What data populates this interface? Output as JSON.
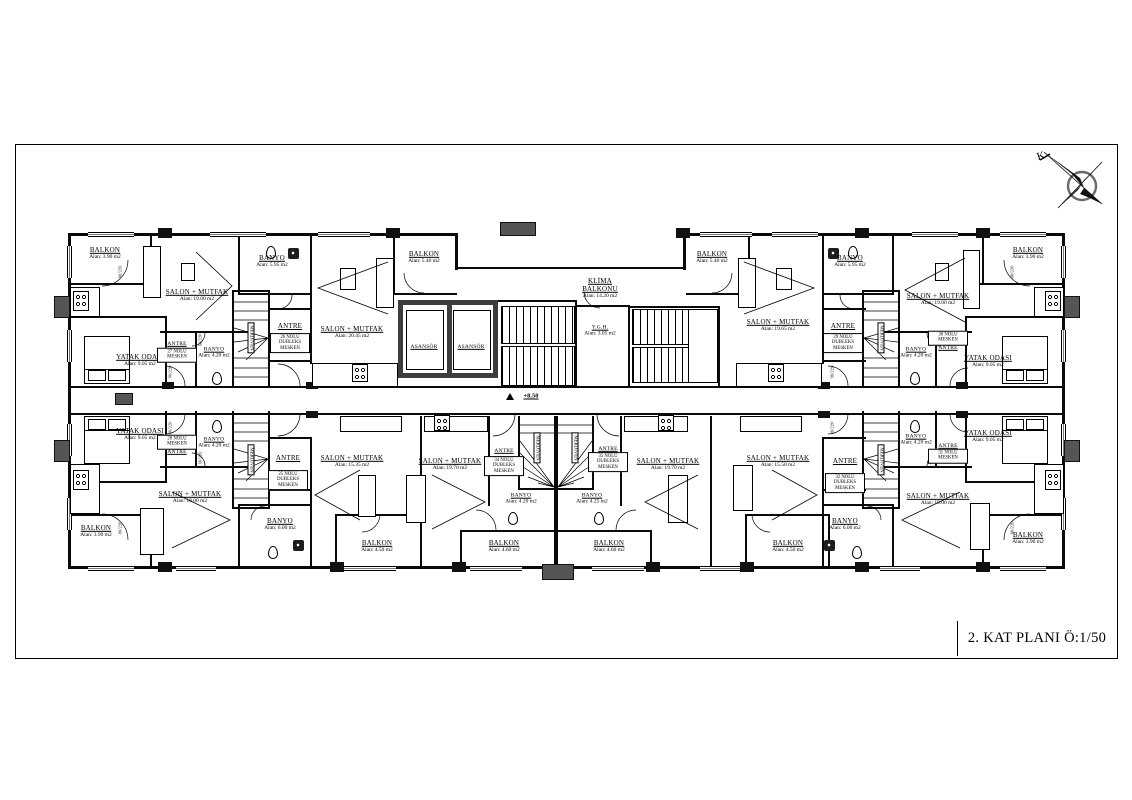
{
  "plan": {
    "title": "2. KAT PLANI Ö:1/50",
    "compass_label": "K",
    "level_mark": "+8.50",
    "stair_label": "MERDİVEN",
    "elevator_label": "ASANSÖR"
  },
  "doors": {
    "size_90": "90/220",
    "size_80": "80/220",
    "size_60": "60/220"
  },
  "units": {
    "u25": "25 NOLU DUBLEKS MESKEN",
    "u26": "26 NOLU DUBLEKS MESKEN",
    "u27": "27 NOLU MESKEN",
    "u28": "28 NOLU MESKEN",
    "u29": "29 NOLU DUBLEKS MESKEN",
    "u30": "30 NOLU MESKEN",
    "u31": "31 NOLU MESKEN",
    "u32": "32 NOLU DUBLEKS MESKEN",
    "u34": "34 NOLU DUBLEKS MESKEN",
    "u35": "35 NOLU DUBLEKS MESKEN"
  },
  "rooms": {
    "t1": {
      "name": "BALKON",
      "area": "Alan: 3.90 m2"
    },
    "t2": {
      "name": "SALON + MUTFAK",
      "area": "Alan: 19.00 m2"
    },
    "t3": {
      "name": "YATAK ODASI",
      "area": "Alan: 9.05 m2"
    },
    "t4": {
      "name": "ANTRE"
    },
    "t5": {
      "name": "BANYO",
      "area": "Alan: 4.20 m2"
    },
    "t6": {
      "name": "BANYO",
      "area": "Alan: 5.95 m2"
    },
    "t7": {
      "name": "ANTRE"
    },
    "t8": {
      "name": "SALON + MUTFAK",
      "area": "Alan: 20.45 m2"
    },
    "t9": {
      "name": "BALKON",
      "area": "Alan: 5.40 m2"
    },
    "t12": {
      "name": "KLİMA BALKONU",
      "area": "Alan: 14.20 m2"
    },
    "t13": {
      "name": "Y.G.H.",
      "area": "Alan: 3.05 m2"
    },
    "t14": {
      "name": "BALKON",
      "area": "Alan: 5.40 m2"
    },
    "t15": {
      "name": "SALON + MUTFAK",
      "area": "Alan: 19.65 m2"
    },
    "t16": {
      "name": "BANYO",
      "area": "Alan: 5.95 m2"
    },
    "t17": {
      "name": "ANTRE"
    },
    "t18": {
      "name": "SALON + MUTFAK",
      "area": "Alan: 19.00 m2"
    },
    "t19": {
      "name": "BANYO",
      "area": "Alan: 4.20 m2"
    },
    "t20": {
      "name": "ANTRE"
    },
    "t21": {
      "name": "YATAK ODASI",
      "area": "Alan: 9.05 m2"
    },
    "t22": {
      "name": "BALKON",
      "area": "Alan: 3.90 m2"
    },
    "b1": {
      "name": "YATAK ODASI",
      "area": "Alan: 9.05 m2"
    },
    "b2": {
      "name": "ANTRE"
    },
    "b3": {
      "name": "BANYO",
      "area": "Alan: 4.20 m2"
    },
    "b4": {
      "name": "SALON + MUTFAK",
      "area": "Alan: 19.00 m2"
    },
    "b5": {
      "name": "BALKON",
      "area": "Alan: 3.90 m2"
    },
    "b6": {
      "name": "BANYO",
      "area": "Alan: 6.00 m2"
    },
    "b7": {
      "name": "ANTRE"
    },
    "b8": {
      "name": "SALON + MUTFAK",
      "area": "Alan: 15.35 m2"
    },
    "b9": {
      "name": "BALKON",
      "area": "Alan: 4.50 m2"
    },
    "b10": {
      "name": "SALON + MUTFAK",
      "area": "Alan: 19.70 m2"
    },
    "b11": {
      "name": "ANTRE"
    },
    "b12": {
      "name": "BANYO",
      "area": "Alan: 4.20 m2"
    },
    "b13": {
      "name": "BALKON",
      "area": "Alan: 4.60 m2"
    },
    "b14": {
      "name": "ANTRE"
    },
    "b15": {
      "name": "BANYO",
      "area": "Alan: 4.25 m2"
    },
    "b16": {
      "name": "BALKON",
      "area": "Alan: 4.60 m2"
    },
    "b17": {
      "name": "SALON + MUTFAK",
      "area": "Alan: 19.70 m2"
    },
    "b18": {
      "name": "SALON + MUTFAK",
      "area": "Alan: 15.50 m2"
    },
    "b19": {
      "name": "ANTRE"
    },
    "b20": {
      "name": "BANYO",
      "area": "Alan: 6.00 m2"
    },
    "b21": {
      "name": "BALKON",
      "area": "Alan: 4.50 m2"
    },
    "b22": {
      "name": "BANYO",
      "area": "Alan: 4.20 m2"
    },
    "b23": {
      "name": "ANTRE"
    },
    "b24": {
      "name": "YATAK ODASI",
      "area": "Alan: 9.05 m2"
    },
    "b25": {
      "name": "SALON + MUTFAK",
      "area": "Alan: 19.00 m2"
    },
    "b26": {
      "name": "BALKON",
      "area": "Alan: 3.90 m2"
    }
  }
}
